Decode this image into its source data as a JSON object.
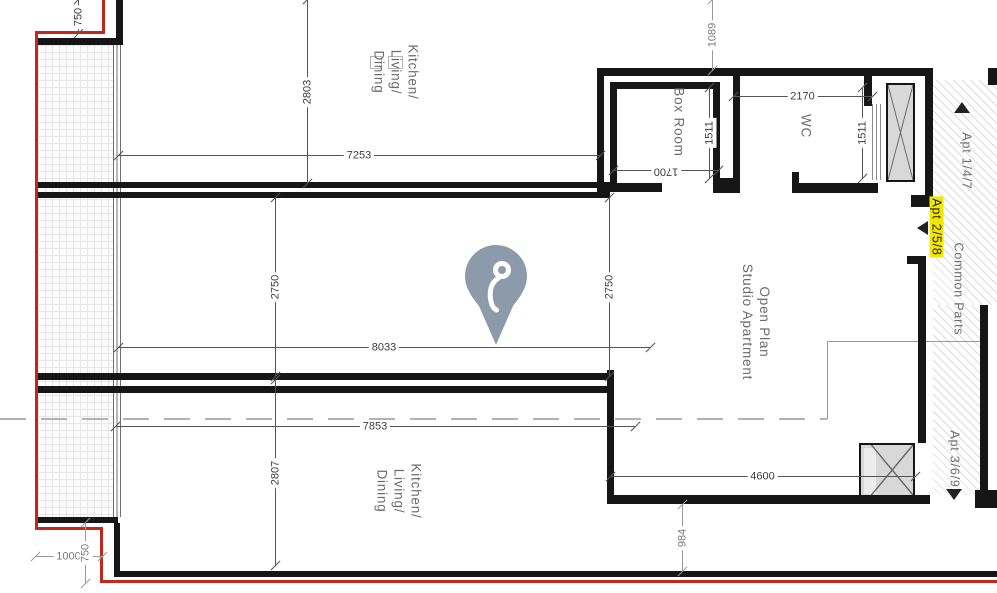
{
  "colors": {
    "wall": "#161616",
    "red_line": "#c1271b",
    "pin": "#8d9aa9",
    "highlight": "#f3e600"
  },
  "rooms": [
    {
      "name": "room-kitchen-living-dining-upper",
      "x": 396,
      "y": 72,
      "lines": [
        "Kitchen/",
        "Living/",
        "Dining"
      ]
    },
    {
      "name": "room-box-room",
      "x": 679,
      "y": 122,
      "lines": [
        "Box Room"
      ]
    },
    {
      "name": "room-wc",
      "x": 806,
      "y": 126,
      "lines": [
        "WC"
      ]
    },
    {
      "name": "room-open-plan-studio",
      "x": 756,
      "y": 322,
      "lines": [
        "Open Plan",
        "Studio Apartment"
      ]
    },
    {
      "name": "room-kitchen-living-dining-lower",
      "x": 399,
      "y": 491,
      "lines": [
        "Kitchen/",
        "Living/",
        "Dining"
      ]
    },
    {
      "name": "label-apt-1-4-7",
      "x": 966,
      "y": 161,
      "lines": [
        "Apt 1/4/7"
      ],
      "small": true
    },
    {
      "name": "label-apt-2-5-8",
      "x": 936,
      "y": 227,
      "lines": [
        "Apt 2/5/8"
      ],
      "small": true,
      "highlight": true
    },
    {
      "name": "label-common-parts",
      "x": 958,
      "y": 289,
      "lines": [
        "Common Parts"
      ],
      "small": true
    },
    {
      "name": "label-apt-3-6-9",
      "x": 954,
      "y": 459,
      "lines": [
        "Apt 3/6/9"
      ],
      "small": true
    }
  ],
  "dimensions": [
    {
      "label": "7253",
      "orient": "h",
      "x": 118,
      "y": 155,
      "len": 482
    },
    {
      "label": "2170",
      "orient": "h",
      "x": 733,
      "y": 96,
      "len": 139
    },
    {
      "label": "1700",
      "orient": "h",
      "x": 613,
      "y": 170,
      "len": 105,
      "flip": true
    },
    {
      "label": "8033",
      "orient": "h",
      "x": 118,
      "y": 347,
      "len": 532
    },
    {
      "label": "7853",
      "orient": "h",
      "x": 115,
      "y": 426,
      "len": 520
    },
    {
      "label": "4600",
      "orient": "h",
      "x": 610,
      "y": 476,
      "len": 305
    },
    {
      "label": "1000",
      "orient": "h",
      "x": 35,
      "y": 556,
      "len": 67,
      "muted": true
    },
    {
      "label": "750",
      "orient": "v",
      "x": 78,
      "y": 0,
      "len": 33
    },
    {
      "label": "2803",
      "orient": "v",
      "x": 307,
      "y": 0,
      "len": 183
    },
    {
      "label": "1089",
      "orient": "v",
      "x": 712,
      "y": 0,
      "len": 70,
      "muted": true
    },
    {
      "label": "1511",
      "orient": "v",
      "x": 709,
      "y": 88,
      "len": 90
    },
    {
      "label": "1511",
      "orient": "v",
      "x": 862,
      "y": 88,
      "len": 90
    },
    {
      "label": "2750",
      "orient": "v",
      "x": 275,
      "y": 198,
      "len": 178
    },
    {
      "label": "2750",
      "orient": "v",
      "x": 609,
      "y": 198,
      "len": 178
    },
    {
      "label": "2807",
      "orient": "v",
      "x": 275,
      "y": 380,
      "len": 185
    },
    {
      "label": "984",
      "orient": "v",
      "x": 682,
      "y": 505,
      "len": 66,
      "muted": true
    },
    {
      "label": "750",
      "orient": "v",
      "x": 85,
      "y": 523,
      "len": 60,
      "muted": true
    }
  ],
  "arrows": [
    {
      "name": "arrow-up-apt-1-4-7",
      "dir": "up",
      "x": 954,
      "y": 102
    },
    {
      "name": "arrow-left-apt-2-5-8",
      "dir": "left",
      "x": 917,
      "y": 221
    },
    {
      "name": "arrow-down-apt-3-6-9",
      "dir": "down",
      "x": 946,
      "y": 489
    }
  ],
  "marker": {
    "name": "map-pin"
  }
}
